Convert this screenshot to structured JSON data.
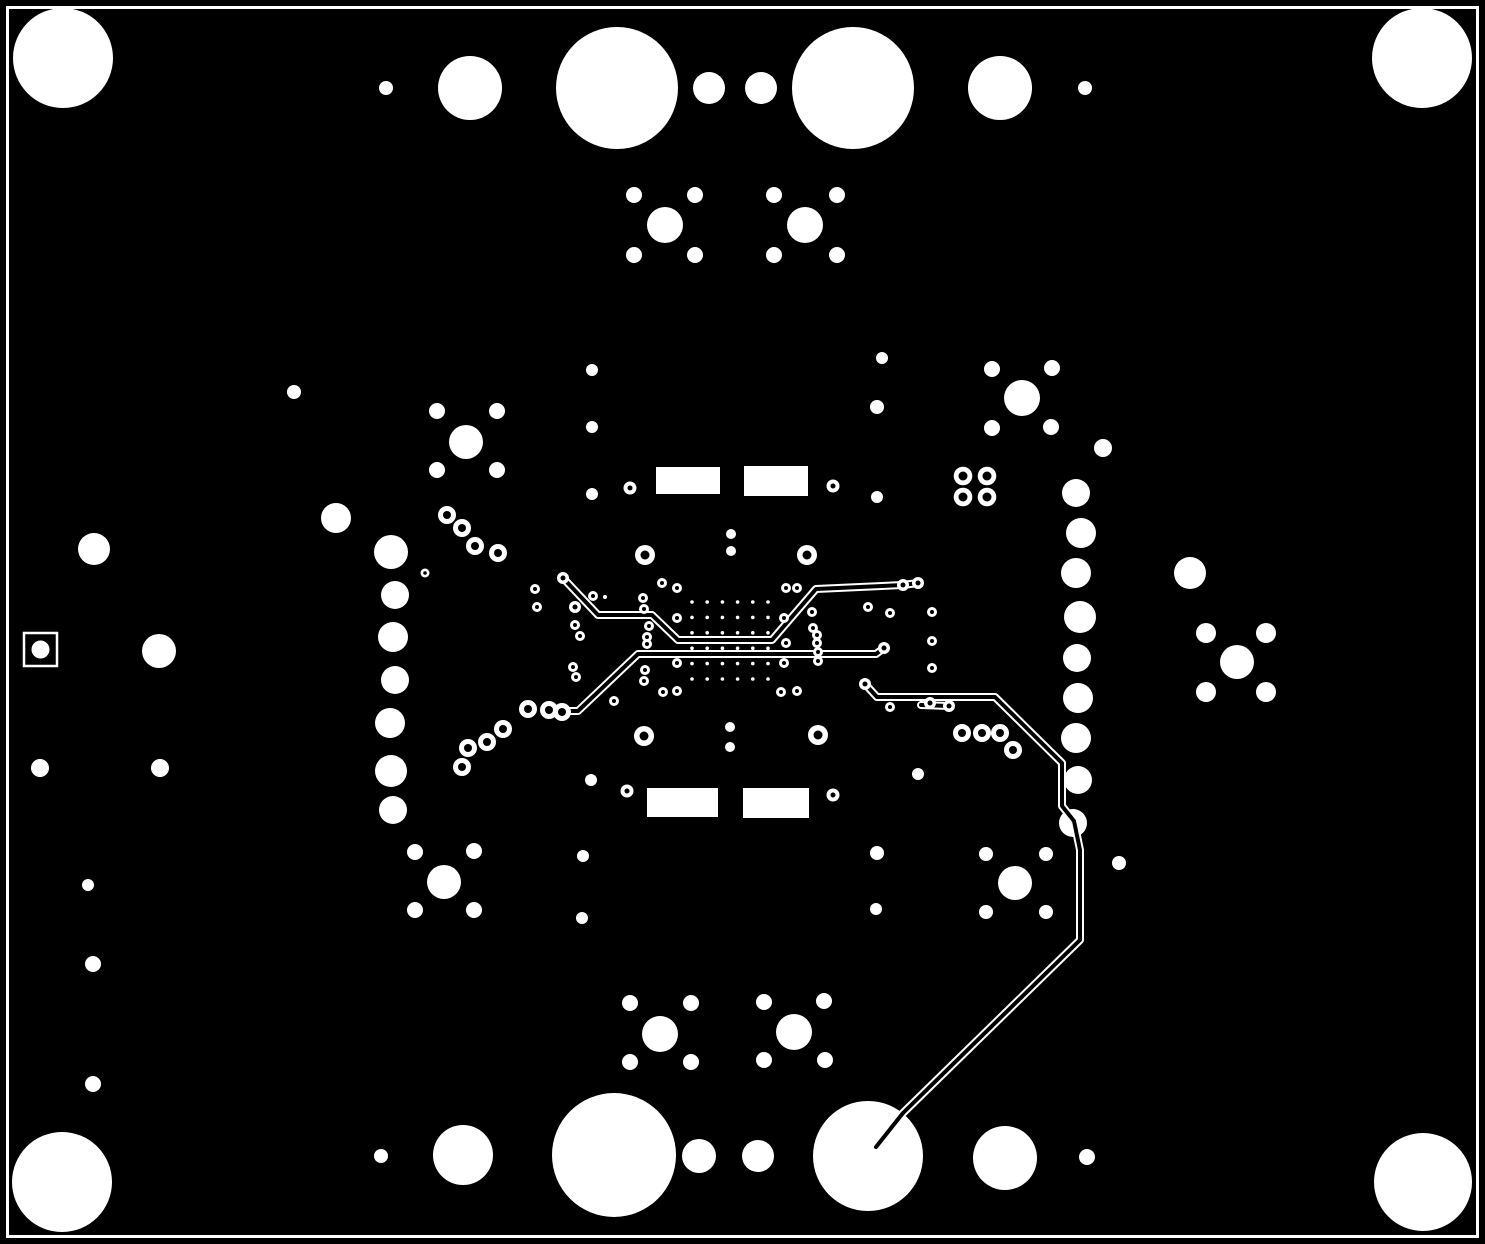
{
  "board": {
    "width": 1485,
    "height": 1244,
    "background_color": "#000000",
    "copper_clear_color": "#ffffff",
    "outline": {
      "x": 7.5,
      "y": 7.5,
      "width": 1470,
      "height": 1229,
      "stroke_width": 3
    },
    "fiducial_square": {
      "x": 24,
      "y": 633,
      "size": 33,
      "stroke_width": 2.5,
      "dot": [
        40.5,
        649.5,
        9
      ]
    },
    "smd_rect_pads": [
      [
        656,
        467,
        64,
        27
      ],
      [
        744,
        466,
        64,
        30
      ],
      [
        647,
        788,
        71,
        29
      ],
      [
        743,
        788,
        66,
        30
      ]
    ],
    "solid_pads": [
      [
        63,
        58,
        50
      ],
      [
        1422,
        58,
        50
      ],
      [
        62,
        1182,
        50
      ],
      [
        1423,
        1182,
        49
      ],
      [
        386,
        88,
        7
      ],
      [
        470,
        88,
        32
      ],
      [
        617,
        88,
        61
      ],
      [
        709,
        88,
        16
      ],
      [
        761,
        88,
        16
      ],
      [
        853,
        88,
        61
      ],
      [
        1000,
        88,
        32
      ],
      [
        1085,
        88,
        7
      ],
      [
        665,
        225,
        18
      ],
      [
        634,
        195,
        8
      ],
      [
        695,
        195,
        8
      ],
      [
        634,
        255,
        8
      ],
      [
        695,
        255,
        8
      ],
      [
        805,
        225,
        18
      ],
      [
        774,
        195,
        8
      ],
      [
        837,
        195,
        8
      ],
      [
        774,
        255,
        8
      ],
      [
        837,
        255,
        8
      ],
      [
        294,
        392,
        7
      ],
      [
        336,
        518,
        15
      ],
      [
        466,
        442,
        17
      ],
      [
        437,
        411,
        8
      ],
      [
        497,
        411,
        8
      ],
      [
        437,
        470,
        8
      ],
      [
        497,
        470,
        8
      ],
      [
        391,
        552,
        17
      ],
      [
        395,
        595,
        14
      ],
      [
        393,
        637,
        15
      ],
      [
        395,
        680,
        14
      ],
      [
        390,
        723,
        15
      ],
      [
        391,
        771,
        16
      ],
      [
        393,
        810,
        14
      ],
      [
        94,
        549,
        16
      ],
      [
        159,
        651,
        17
      ],
      [
        40,
        768,
        9
      ],
      [
        160,
        768,
        9
      ],
      [
        88,
        885,
        6
      ],
      [
        93,
        964,
        8
      ],
      [
        93,
        1084,
        8
      ],
      [
        381,
        1156,
        7
      ],
      [
        463,
        1155,
        30
      ],
      [
        614,
        1155,
        62
      ],
      [
        699,
        1156,
        17
      ],
      [
        758,
        1156,
        16
      ],
      [
        868,
        1156,
        55
      ],
      [
        1005,
        1158,
        32
      ],
      [
        1087,
        1157,
        8
      ],
      [
        660,
        1034,
        18
      ],
      [
        630,
        1003,
        8
      ],
      [
        691,
        1003,
        8
      ],
      [
        630,
        1062,
        8
      ],
      [
        691,
        1062,
        8
      ],
      [
        794,
        1032,
        18
      ],
      [
        764,
        1002,
        8
      ],
      [
        824,
        1001,
        8
      ],
      [
        764,
        1060,
        8
      ],
      [
        825,
        1060,
        8
      ],
      [
        444,
        882,
        17
      ],
      [
        415,
        852,
        8
      ],
      [
        474,
        851,
        8
      ],
      [
        415,
        910,
        8
      ],
      [
        474,
        910,
        8
      ],
      [
        1015,
        883,
        17
      ],
      [
        986,
        854,
        7
      ],
      [
        1046,
        854,
        7
      ],
      [
        986,
        912,
        7
      ],
      [
        1046,
        912,
        7
      ],
      [
        1119,
        863,
        7
      ],
      [
        1076,
        493,
        14
      ],
      [
        1081,
        533,
        15
      ],
      [
        1076,
        573,
        15
      ],
      [
        1080,
        617,
        16
      ],
      [
        1077,
        658,
        14
      ],
      [
        1078,
        698,
        15
      ],
      [
        1076,
        738,
        15
      ],
      [
        1078,
        780,
        14
      ],
      [
        1073,
        823,
        14
      ],
      [
        1190,
        573,
        16
      ],
      [
        1103,
        448,
        9
      ],
      [
        1237,
        662,
        17
      ],
      [
        1206,
        633,
        10
      ],
      [
        1266,
        633,
        10
      ],
      [
        1206,
        692,
        10
      ],
      [
        1266,
        692,
        10
      ],
      [
        1022,
        398,
        18
      ],
      [
        992,
        369,
        8
      ],
      [
        1052,
        368,
        8
      ],
      [
        992,
        428,
        8
      ],
      [
        1051,
        427,
        8
      ],
      [
        592,
        370,
        6
      ],
      [
        592,
        427,
        6
      ],
      [
        592,
        494,
        6
      ],
      [
        591,
        780,
        6
      ],
      [
        583,
        856,
        6
      ],
      [
        582,
        918,
        6
      ],
      [
        882,
        358,
        6
      ],
      [
        877,
        407,
        7
      ],
      [
        877,
        497,
        6
      ],
      [
        918,
        774,
        6
      ],
      [
        877,
        853,
        7
      ],
      [
        876,
        909,
        6
      ],
      [
        731,
        534,
        5
      ],
      [
        731,
        551,
        5
      ],
      [
        730,
        727,
        5
      ],
      [
        730,
        747,
        5
      ],
      [
        605,
        597,
        2
      ]
    ],
    "ring_vias": [
      [
        645,
        555,
        10,
        4.5
      ],
      [
        807,
        555,
        10,
        4.5
      ],
      [
        644,
        736,
        10,
        4.5
      ],
      [
        818,
        735,
        10,
        4.5
      ],
      [
        630,
        488,
        6.5,
        2.5
      ],
      [
        833,
        486,
        6.5,
        2.5
      ],
      [
        627,
        791,
        6.5,
        2.5
      ],
      [
        833,
        795,
        6.5,
        2.5
      ],
      [
        447,
        515,
        9,
        4
      ],
      [
        462,
        528,
        9,
        4
      ],
      [
        475,
        546,
        9,
        4
      ],
      [
        498,
        553,
        9,
        4
      ],
      [
        528,
        709,
        9,
        4
      ],
      [
        549,
        710,
        9,
        4
      ],
      [
        562,
        712,
        9,
        4
      ],
      [
        503,
        729,
        9,
        4
      ],
      [
        487,
        742,
        9,
        4
      ],
      [
        468,
        748,
        9,
        4
      ],
      [
        462,
        767,
        9,
        4
      ],
      [
        425,
        573,
        4.5,
        1.8
      ],
      [
        535,
        589,
        5,
        2
      ],
      [
        537,
        607,
        5,
        2
      ],
      [
        575,
        625,
        5,
        2
      ],
      [
        580,
        636,
        5,
        2
      ],
      [
        573,
        667,
        5,
        2
      ],
      [
        576,
        677,
        5,
        2
      ],
      [
        563,
        578,
        6,
        2.5
      ],
      [
        575,
        607,
        6,
        2.5
      ],
      [
        903,
        585,
        6,
        2.5
      ],
      [
        918,
        583,
        6,
        2.5
      ],
      [
        593,
        596,
        5,
        2
      ],
      [
        643,
        598,
        5,
        2
      ],
      [
        644,
        609,
        5,
        2
      ],
      [
        649,
        626,
        5,
        2
      ],
      [
        647,
        637,
        5,
        2
      ],
      [
        647,
        644,
        5,
        2
      ],
      [
        645,
        670,
        5,
        2
      ],
      [
        644,
        681,
        5,
        2
      ],
      [
        663,
        692,
        5,
        2
      ],
      [
        677,
        691,
        5,
        2
      ],
      [
        614,
        701,
        5,
        2
      ],
      [
        662,
        583,
        5,
        2
      ],
      [
        677,
        588,
        5,
        2
      ],
      [
        677,
        618,
        5,
        2
      ],
      [
        677,
        663,
        5,
        2
      ],
      [
        786,
        588,
        5,
        2
      ],
      [
        797,
        588,
        5,
        2
      ],
      [
        784,
        618,
        5,
        2
      ],
      [
        784,
        663,
        5,
        2
      ],
      [
        781,
        692,
        5,
        2
      ],
      [
        797,
        691,
        5,
        2
      ],
      [
        786,
        643,
        5,
        2
      ],
      [
        812,
        612,
        5,
        2
      ],
      [
        813,
        628,
        5,
        2
      ],
      [
        817,
        635,
        5,
        2
      ],
      [
        817,
        643,
        5,
        2
      ],
      [
        818,
        652,
        5,
        2
      ],
      [
        818,
        661,
        5,
        2
      ],
      [
        868,
        607,
        5,
        2
      ],
      [
        890,
        613,
        5,
        2
      ],
      [
        932,
        612,
        5,
        2
      ],
      [
        932,
        641,
        5,
        2
      ],
      [
        932,
        668,
        5,
        2
      ],
      [
        890,
        707,
        5,
        2
      ],
      [
        930,
        703,
        6,
        2.5
      ],
      [
        949,
        706,
        6,
        2.5
      ],
      [
        865,
        684,
        6,
        2.5
      ],
      [
        884,
        648,
        6,
        2.5
      ],
      [
        962,
        733,
        9,
        4
      ],
      [
        982,
        733,
        9,
        4
      ],
      [
        1000,
        733,
        9,
        4
      ],
      [
        1013,
        750,
        9,
        4
      ],
      [
        963,
        476,
        9.3,
        4.5
      ],
      [
        987,
        476,
        9.3,
        4.5
      ],
      [
        963,
        497,
        9.3,
        4.5
      ],
      [
        987,
        497,
        9.3,
        4.5
      ]
    ],
    "thermal_via_grid": {
      "x0": 692,
      "y0": 602,
      "dx": 15.2,
      "dy": 15.4,
      "cols": 6,
      "rows": 6,
      "r": 1.8
    },
    "traces": {
      "outline_width": 8,
      "core_width": 4,
      "paths": [
        [
          [
            563,
            578
          ],
          [
            598,
            615
          ],
          [
            652,
            615
          ],
          [
            678,
            640
          ],
          [
            772,
            640
          ],
          [
            816,
            589
          ],
          [
            903,
            585
          ],
          [
            918,
            583
          ]
        ],
        [
          [
            547,
            714
          ],
          [
            563,
            711
          ],
          [
            578,
            711
          ],
          [
            638,
            654
          ],
          [
            876,
            654
          ],
          [
            884,
            648
          ]
        ],
        [
          [
            865,
            684
          ],
          [
            877,
            697
          ],
          [
            995,
            697
          ],
          [
            1062,
            763
          ],
          [
            1062,
            806
          ],
          [
            1074,
            821
          ],
          [
            1080,
            850
          ],
          [
            1080,
            940
          ],
          [
            903,
            1113
          ],
          [
            876,
            1147
          ]
        ],
        [
          [
            921,
            705
          ],
          [
            949,
            706
          ]
        ]
      ]
    }
  }
}
